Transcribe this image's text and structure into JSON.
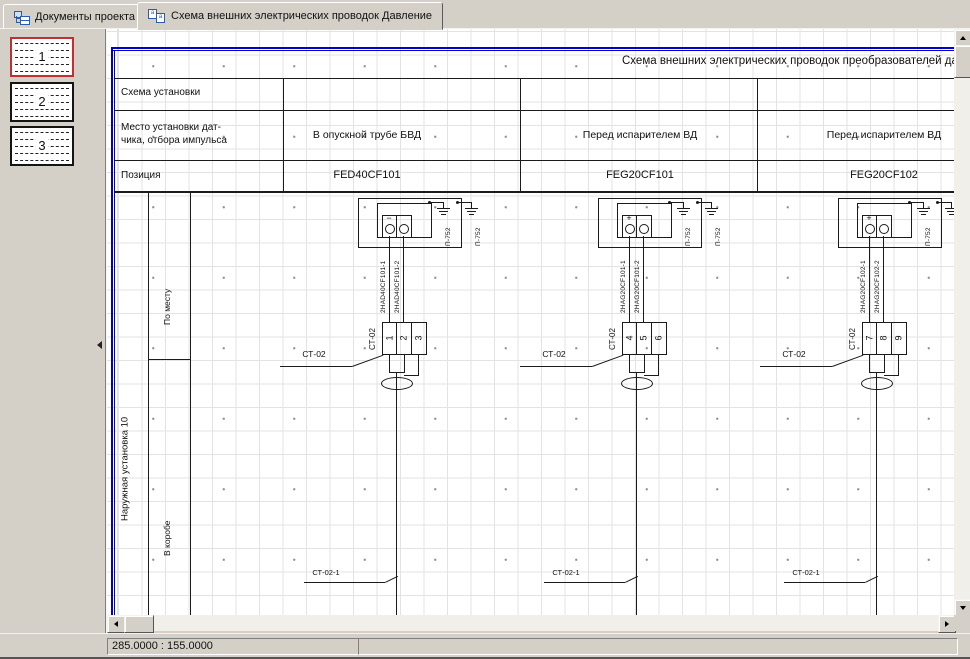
{
  "window": {
    "tabs": [
      {
        "label": "Документы проекта",
        "icon": "project-tree-icon",
        "active": false
      },
      {
        "label": "Схема внешних электрических проводок Давление",
        "icon": "page-icon",
        "active": true
      }
    ]
  },
  "pages_panel": {
    "thumbnails": [
      {
        "number": "1",
        "selected": true
      },
      {
        "number": "2",
        "selected": false
      },
      {
        "number": "3",
        "selected": false
      }
    ]
  },
  "drawing": {
    "title": "Схема внешних электрических проводок преобразователей да",
    "table": {
      "row_labels": {
        "scheme": "Схема установки",
        "place_line1": "Место установки дат-",
        "place_line2": "чика, отбора импульса",
        "position": "Позиция"
      },
      "columns": [
        {
          "location": "В опускной трубе БВД",
          "position": "FED40CF101"
        },
        {
          "location": "Перед испарителем ВД",
          "position": "FEG20CF101"
        },
        {
          "location": "Перед испарителем ВД",
          "position": "FEG20CF102"
        }
      ]
    },
    "side_labels": {
      "area": "Наружная установка 10",
      "local": "По месту",
      "duct": "В коробе"
    },
    "blocks": [
      {
        "polarity": "−",
        "ground_label": "П-752",
        "cable1": "2HAD40CF101-1",
        "cable2": "2HAD40CF101-2",
        "strip_label": "СТ-02",
        "terminals": [
          "1",
          "2",
          "3"
        ],
        "leader_label": "СТ-02",
        "bottom_label": "СТ-02-1"
      },
      {
        "polarity": "+",
        "ground_label": "П-752",
        "cable1": "2HAG20CF101-1",
        "cable2": "2HAG20CF101-2",
        "strip_label": "СТ-02",
        "terminals": [
          "4",
          "5",
          "6"
        ],
        "leader_label": "СТ-02",
        "bottom_label": "СТ-02-1"
      },
      {
        "polarity": "+",
        "ground_label": "П-752",
        "cable1": "2HAG20CF102-1",
        "cable2": "2HAG20CF102-2",
        "strip_label": "СТ-02",
        "terminals": [
          "7",
          "8",
          "9"
        ],
        "leader_label": "СТ-02",
        "bottom_label": "СТ-02-1"
      }
    ]
  },
  "statusbar": {
    "coordinates": "285.0000 : 155.0000"
  }
}
